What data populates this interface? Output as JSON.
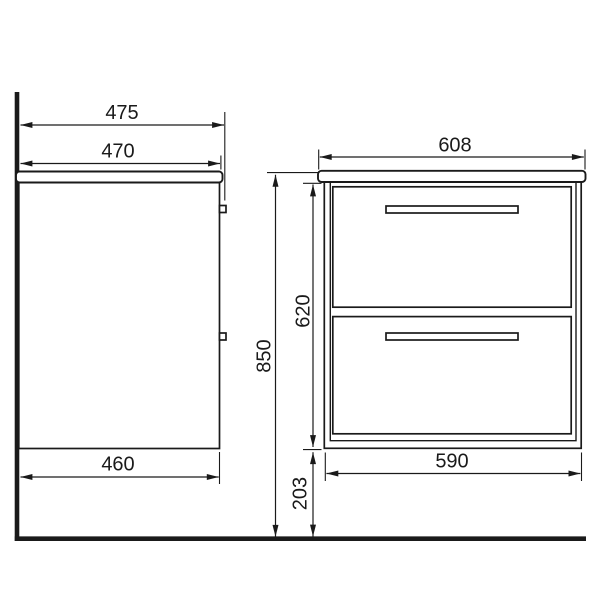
{
  "drawing": {
    "colors": {
      "line": "#1a1a1a",
      "background": "#ffffff"
    },
    "side_view": {
      "overall_depth": "475",
      "countertop_depth": "470",
      "cabinet_depth": "460"
    },
    "front_view": {
      "countertop_width": "608",
      "cabinet_width": "590"
    },
    "heights": {
      "overall_height": "850",
      "cabinet_height": "620",
      "floor_clearance": "203"
    }
  }
}
